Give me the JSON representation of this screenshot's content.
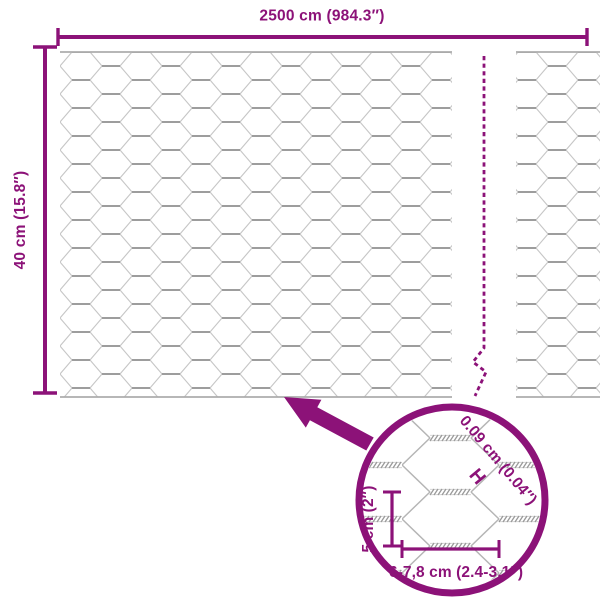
{
  "diagram": {
    "type": "product-dimension-diagram",
    "subject": "hexagonal chicken wire mesh roll",
    "accent_color": "#8C1278",
    "mesh_wire_color": "#c6c6c6",
    "labels": {
      "total_length": "2500 cm (984.3″)",
      "roll_height": "40 cm (15.8″)",
      "wire_thickness": "0.09 cm (0.04″)",
      "wire_thickness_marker": "H",
      "mesh_height": "5 cm (2″)",
      "mesh_width": "6-7,8 cm (2.4-3.1″)"
    }
  }
}
